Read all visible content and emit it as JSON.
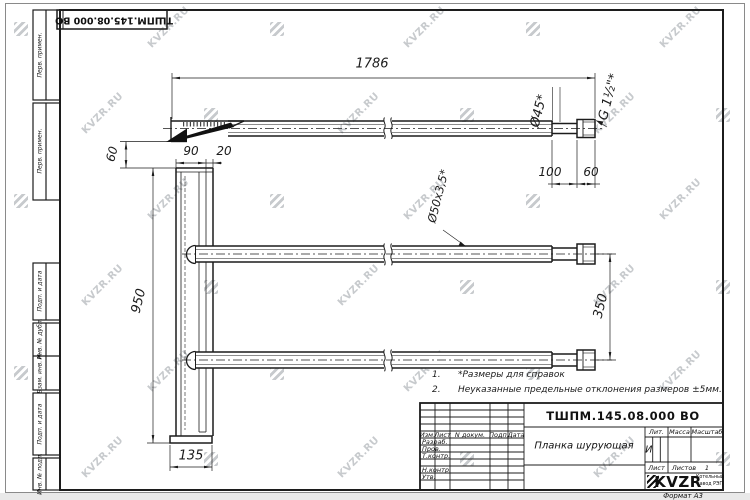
{
  "watermark": {
    "text": "KVZR.RU"
  },
  "corner_stamp": "ТШПМ.145.08.000 ВО",
  "frame": {
    "side_labels": [
      "Перв. примен.",
      "Перв. примен.",
      "Подп. и дата",
      "Инв. № дубл.",
      "Взам. инв. №",
      "Подп. и дата",
      "Инв. № подл."
    ],
    "format_note": "Формат А3"
  },
  "dimensions": {
    "length_overall": "1786",
    "dia_45": "Ø45*",
    "thread": "G 1½\"*",
    "len_100": "100",
    "len_60": "60",
    "offset_60": "60",
    "plate_90": "90",
    "plate_20": "20",
    "height_950": "950",
    "width_135": "135",
    "spacing_350": "350",
    "tube_spec": "Ø50х3,5*"
  },
  "notes": {
    "n1_num": "1.",
    "n1_text": "*Размеры для справок",
    "n2_num": "2.",
    "n2_text": "Неуказанные предельные отклонения размеров ±5мм."
  },
  "title_block": {
    "doc_number": "ТШПМ.145.08.000 ВО",
    "part_name": "Планка шурующая",
    "lit_value": "И",
    "cols": {
      "izm": "Изм.",
      "list": "Лист",
      "doc": "N докум.",
      "podp": "Подп.",
      "data": "Дата"
    },
    "rows": {
      "razrab": "Разраб.",
      "prov": "Пров.",
      "tkontr": "Т.контр.",
      "nkontr": "Н.контр.",
      "utv": "Утв."
    },
    "right": {
      "lit": "Лит.",
      "massa": "Масса",
      "masshtab": "Масштаб",
      "list": "Лист",
      "listov": "Листов",
      "listov_value": "1"
    },
    "logo": {
      "name": "KVZR",
      "org_line1": "Котельный",
      "org_line2": "завод РЭП"
    }
  }
}
